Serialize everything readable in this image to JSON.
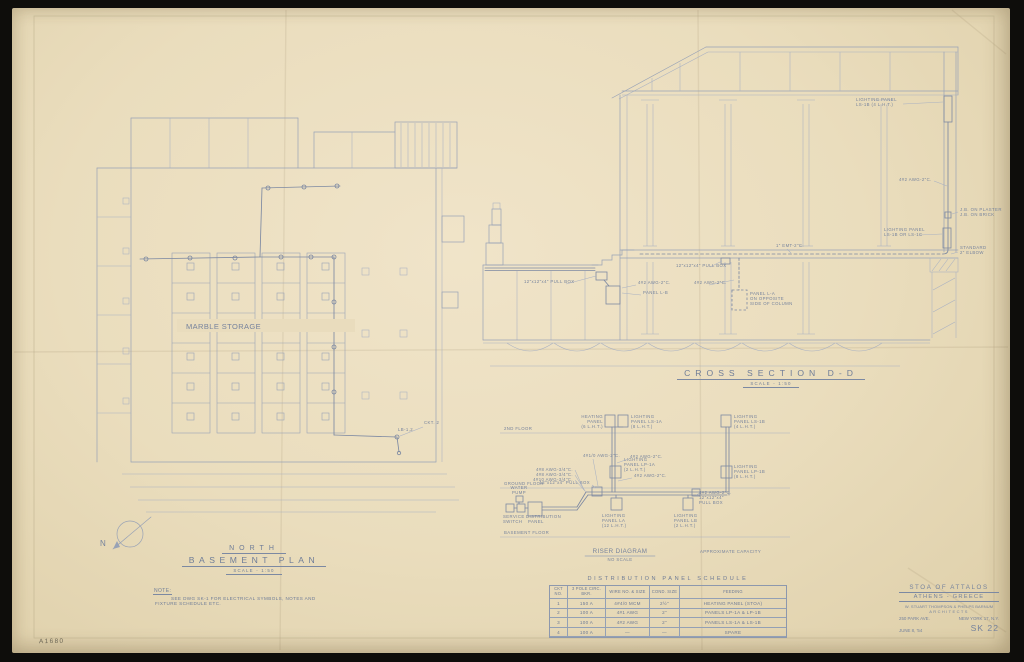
{
  "scan": {
    "sheet_ref": "A1680"
  },
  "title_block": {
    "project": "STOA OF ATTALOS",
    "location": "ATHENS - GREECE",
    "firm": "W. STUART THOMPSON & PHELPS BARNUM",
    "firm_role": "ARCHITECTS",
    "address": "250 PARK AVE.",
    "city": "NEW YORK 17, N.Y.",
    "date": "JUNE 8, '54",
    "sheet_no": "SK 22"
  },
  "basement_plan": {
    "title_line1": "NORTH",
    "title_line2": "BASEMENT PLAN",
    "scale": "SCALE - 1:50",
    "room": "MARBLE STORAGE",
    "north": "N",
    "ckt_label": "CKT. 2",
    "panel_label": "LB-1,2",
    "note_heading": "NOTE:",
    "note_line1": "SEE DWG SK-1 FOR ELECTRICAL SYMBOLS, NOTES AND",
    "note_line2": "FIXTURE SCHEDULE ETC."
  },
  "cross_section": {
    "title": "CROSS SECTION D-D",
    "scale": "SCALE - 1:50",
    "labels": {
      "panel_top": [
        "LIGHTING PANEL",
        "LS-1B (4 L.H.T.)"
      ],
      "feeder_right": "4#2 AWG-2\"C.",
      "jb_plaster": "J.B. ON PLASTER",
      "jb_brick": "J.B. ON BRICK",
      "panel_wall": [
        "LIGHTING PANEL",
        "LS-1B OR LS-1C"
      ],
      "elbow": [
        "STANDARD",
        "2\" ELBOW"
      ],
      "emt": "1\" EMT-2\"C.",
      "pullbox_mid": "12\"x12\"x4\" PULL BOX",
      "feeder_mid": "4#2 AWG-2\"C.",
      "panel_la": [
        "PANEL L-A",
        "ON OPPOSITE",
        "SIDE OF COLUMN"
      ],
      "pullbox_left": "12\"x12\"x4\" PULL BOX",
      "feeder_left": "4#2 AWG-2\"C.",
      "panel_lb": "PANEL L-B"
    }
  },
  "riser": {
    "title": "RISER DIAGRAM",
    "scale": "NO SCALE",
    "note": "APPROXIMATE CAPACITY",
    "floor_2nd": "2ND FLOOR",
    "floor_ground": "GROUND FLOOR",
    "floor_basement": "BASEMENT FLOOR",
    "heating_panel": [
      "HEATING",
      "PANEL",
      "(6 L.H.T.)"
    ],
    "panel_ls1a": [
      "LIGHTING",
      "PANEL LS-1A",
      "(8 L.H.T.)"
    ],
    "panel_ls1b": [
      "LIGHTING",
      "PANEL LS-1B",
      "(4 L.H.T.)"
    ],
    "panel_lp1a": [
      "LIGHTING",
      "PANEL LP-1A",
      "(2 L.H.T.)"
    ],
    "panel_lp1b": [
      "LIGHTING",
      "PANEL LP-1B",
      "(8 L.H.T.)"
    ],
    "panel_la": [
      "LIGHTING",
      "PANEL LA",
      "(12 L.H.T.)"
    ],
    "panel_lb": [
      "LIGHTING",
      "PANEL LB",
      "(2 L.H.T.)"
    ],
    "water_pump": [
      "WATER",
      "PUMP"
    ],
    "service_switch": [
      "SERVICE",
      "SWITCH"
    ],
    "dist_panel": [
      "DISTRIBUTION",
      "PANEL"
    ],
    "pull_box_main": "12\"x12\"x4\" PULL BOX",
    "pull_box_right": [
      "4#2 AWG-2\"C.",
      "12\"x12\"x4\"",
      "PULL BOX"
    ],
    "feeder_main": "4#1/0 AWG-2\"C.",
    "feeder_mid": "4#2 AWG-2\"C.",
    "feeder_mid2": "4#2 AWG-2\"C.",
    "branch_1": "4#8 AWG-3/4\"C.",
    "branch_2": "4#8 AWG-3/4\"C.",
    "branch_3": "4#10 AWG-3/4\"C."
  },
  "panel_schedule": {
    "title": "DISTRIBUTION PANEL SCHEDULE",
    "headers": [
      "CKT NO.",
      "3 POLE CIRC. BKR.",
      "WIRE NO. & SIZE",
      "COND. SIZE",
      "FEEDING"
    ],
    "rows": [
      [
        "1",
        "150 A",
        "4#4/0 MCM",
        "2½\"",
        "HEATING PANEL (STOA)"
      ],
      [
        "2",
        "100 A",
        "4#1 AWG",
        "2\"",
        "PANELS LP-1A & LP-1B"
      ],
      [
        "3",
        "100 A",
        "4#2 AWG",
        "2\"",
        "PANELS LS-1A & LS-1B"
      ],
      [
        "4",
        "100 A",
        "—",
        "—",
        "SPARE"
      ]
    ]
  }
}
